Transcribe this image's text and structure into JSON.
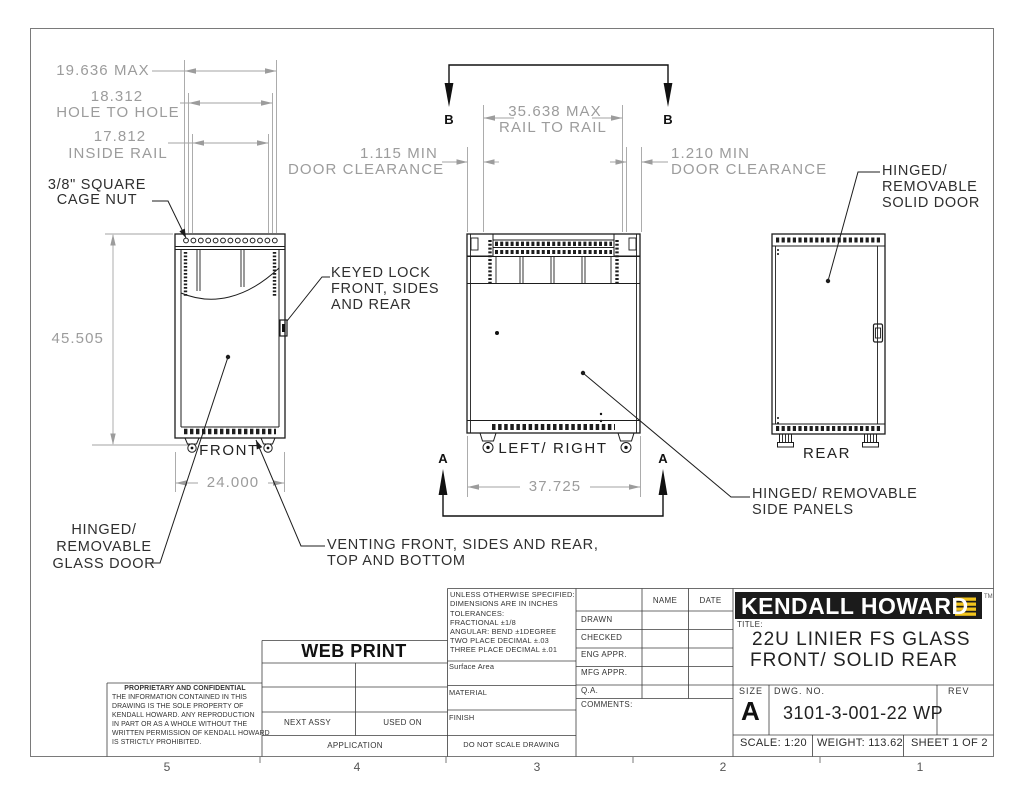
{
  "sheet": {
    "zones": [
      "5",
      "4",
      "3",
      "2",
      "1"
    ]
  },
  "views": {
    "front_label": "FRONT",
    "side_label": "LEFT/ RIGHT",
    "rear_label": "REAR",
    "section_a": "A",
    "section_b": "B"
  },
  "dims": {
    "max_width": "19.636 MAX",
    "hole_to_hole_value": "18.312",
    "hole_to_hole_label": "HOLE TO HOLE",
    "inside_rail_value": "17.812",
    "inside_rail_label": "INSIDE RAIL",
    "height": "45.505",
    "front_width": "24.000",
    "rail_to_rail_l1": "35.638 MAX",
    "rail_to_rail_l2": "RAIL TO RAIL",
    "side_depth": "37.725",
    "door_clear_left_l1": "1.115 MIN",
    "door_clear_left_l2": "DOOR CLEARANCE",
    "door_clear_right_l1": "1.210 MIN",
    "door_clear_right_l2": "DOOR CLEARANCE"
  },
  "callouts": {
    "cage_nut_l1": "3/8\" SQUARE",
    "cage_nut_l2": "CAGE NUT",
    "keyed_lock_l1": "KEYED LOCK",
    "keyed_lock_l2": "FRONT, SIDES",
    "keyed_lock_l3": "AND REAR",
    "glass_door_l1": "HINGED/",
    "glass_door_l2": "REMOVABLE",
    "glass_door_l3": "GLASS DOOR",
    "solid_door_l1": "HINGED/",
    "solid_door_l2": "REMOVABLE",
    "solid_door_l3": "SOLID DOOR",
    "venting_l1": "VENTING FRONT, SIDES AND REAR,",
    "venting_l2": "TOP AND BOTTOM",
    "side_panels_l1": "HINGED/ REMOVABLE",
    "side_panels_l2": "SIDE PANELS"
  },
  "title_block": {
    "tolerances": [
      "UNLESS OTHERWISE SPECIFIED:",
      "DIMENSIONS ARE IN INCHES",
      "TOLERANCES:",
      "FRACTIONAL ±1/8",
      "ANGULAR: BEND ±1DEGREE",
      "TWO PLACE DECIMAL  ±.03",
      "THREE PLACE DECIMAL ±.01"
    ],
    "surface_area": "Surface Area",
    "material": "MATERIAL",
    "finish": "FINISH",
    "do_not_scale": "DO NOT SCALE DRAWING",
    "approvals": {
      "name_header": "NAME",
      "date_header": "DATE",
      "rows": [
        "DRAWN",
        "CHECKED",
        "ENG APPR.",
        "MFG APPR.",
        "Q.A."
      ],
      "comments": "COMMENTS:"
    },
    "proprietary_title": "PROPRIETARY AND CONFIDENTIAL",
    "proprietary_lines": [
      "THE INFORMATION CONTAINED IN THIS",
      "DRAWING IS THE SOLE PROPERTY OF",
      "KENDALL HOWARD.  ANY REPRODUCTION",
      "IN PART OR AS A WHOLE WITHOUT THE",
      "WRITTEN PERMISSION OF KENDALL HOWARD",
      "IS STRICTLY PROHIBITED."
    ],
    "web_print": "WEB PRINT",
    "next_assy": "NEXT ASSY",
    "used_on": "USED ON",
    "application": "APPLICATION",
    "logo_text": "KENDALL HOWARD",
    "logo_tm": "TM",
    "title_label": "TITLE:",
    "title_l1": "22U LINIER FS GLASS",
    "title_l2": "FRONT/ SOLID REAR",
    "size_label": "SIZE",
    "size_value": "A",
    "dwg_label": "DWG. NO.",
    "dwg_value": "3101-3-001-22 WP",
    "rev_label": "REV",
    "scale": "SCALE: 1:20",
    "weight": "WEIGHT: 113.62",
    "sheet": "SHEET 1 OF 2"
  },
  "colors": {
    "dim_gray": "#9c9c9c",
    "line_black": "#1d1d1d",
    "logo_yellow": "#f2c41d",
    "logo_black": "#1b1b1b"
  }
}
